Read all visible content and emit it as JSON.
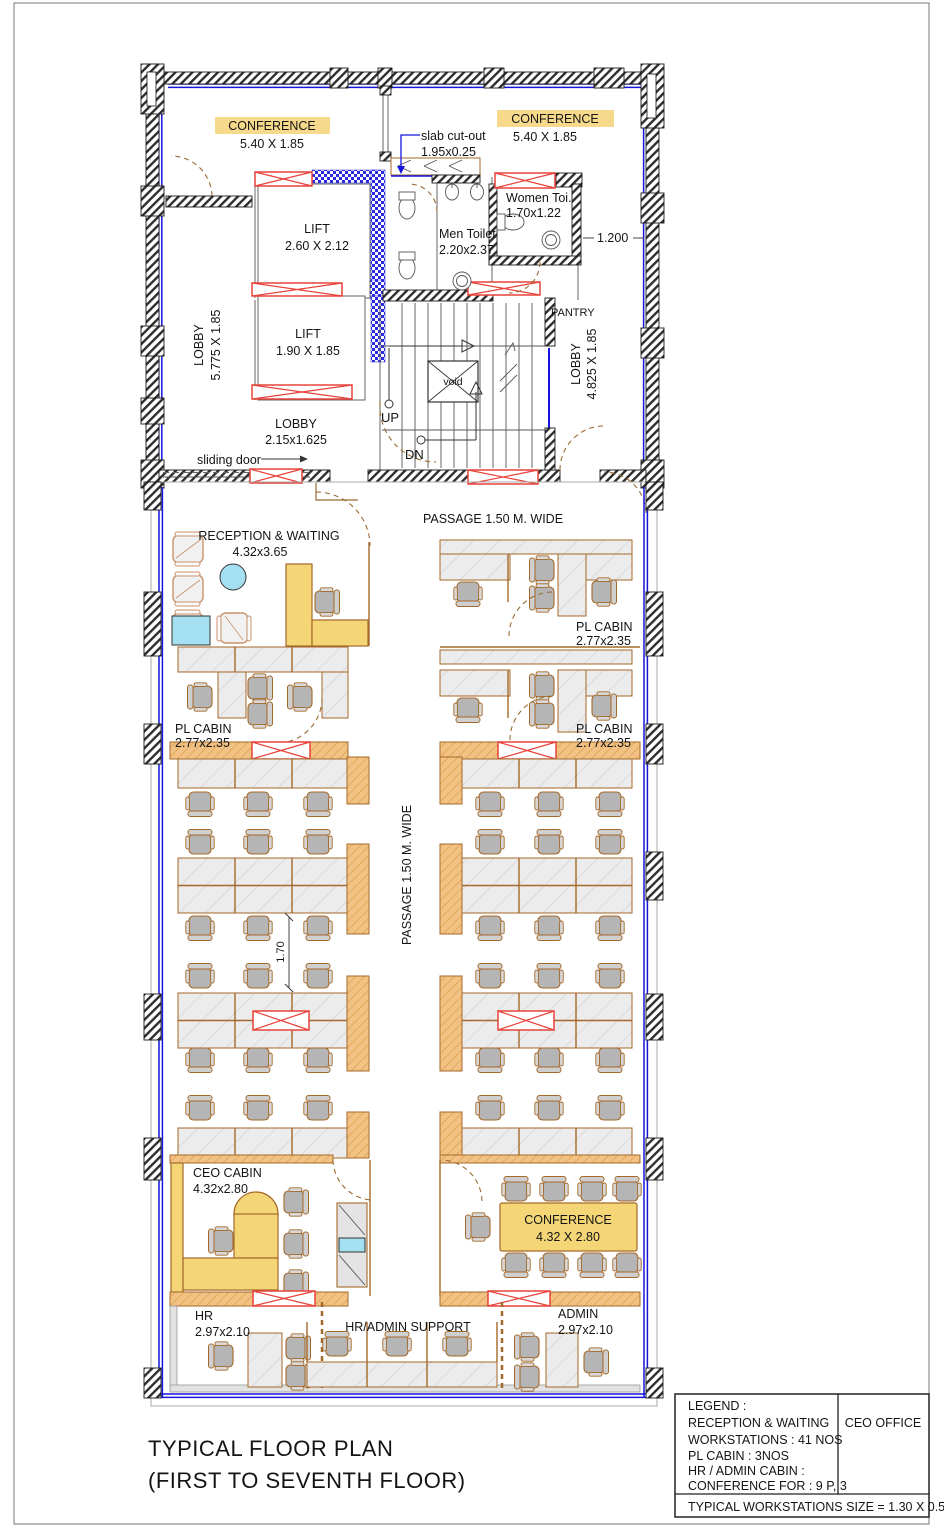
{
  "sheet": {
    "title_line1": "TYPICAL FLOOR PLAN",
    "title_line2": "(FIRST TO SEVENTH FLOOR)"
  },
  "legend": {
    "heading": "LEGEND :",
    "line1": "RECEPTION & WAITING",
    "line2": "WORKSTATIONS  : 41 NOS",
    "line3": "PL CABIN : 3NOS",
    "line4": "HR / ADMIN CABIN  :",
    "line5": "CONFERENCE FOR : 9 P, 3",
    "project": "CEO OFFICE",
    "footer": "TYPICAL WORKSTATIONS SIZE = 1.30 X 0.55"
  },
  "rooms": {
    "conference_top_left": {
      "name": "CONFERENCE",
      "dims": "5.40 X 1.85"
    },
    "conference_top_right": {
      "name": "CONFERENCE",
      "dims": "5.40 X 1.85"
    },
    "lift_upper": {
      "name": "LIFT",
      "dims": "2.60 X 2.12"
    },
    "lift_lower": {
      "name": "LIFT",
      "dims": "1.90 X 1.85"
    },
    "men_toilet": {
      "name": "Men Toilet",
      "dims": "2.20x2.37"
    },
    "women_toilet": {
      "name": "Women Toi.",
      "dims": "1.70x1.22"
    },
    "pantry": {
      "name": "PANTRY"
    },
    "lobby_left": {
      "name": "LOBBY",
      "dims": "5.775 X 1.85"
    },
    "lobby_right": {
      "name": "LOBBY",
      "dims": "4.825 X 1.85"
    },
    "lobby_center": {
      "name": "LOBBY",
      "dims": "2.15x1.625"
    },
    "reception": {
      "name": "RECEPTION & WAITING",
      "dims": "4.32x3.65"
    },
    "pl_cabin_right_upper": {
      "name": "PL CABIN",
      "dims": "2.77x2.35"
    },
    "pl_cabin_left": {
      "name": "PL CABIN",
      "dims": "2.77x2.35"
    },
    "pl_cabin_right_lower": {
      "name": "PL CABIN",
      "dims": "2.77x2.35"
    },
    "ceo_cabin": {
      "name": "CEO CABIN",
      "dims": "4.32x2.80"
    },
    "conference_bottom": {
      "name": "CONFERENCE",
      "dims": "4.32 X 2.80"
    },
    "hr": {
      "name": "HR",
      "dims": "2.97x2.10"
    },
    "hr_admin_support": {
      "name": "HR/ADMIN SUPPORT"
    },
    "admin": {
      "name": "ADMIN",
      "dims": "2.97x2.10"
    }
  },
  "annotations": {
    "slab_cutout_line1": "slab cut-out",
    "slab_cutout_line2": "1.95x0.25",
    "dim_1_200": "1.200",
    "dim_1_70": "1.70",
    "sliding_door": "sliding door",
    "up": "UP",
    "dn": "DN",
    "void": "void",
    "passage_top": "PASSAGE 1.50 M. WIDE",
    "passage_center": "PASSAGE 1.50 M. WIDE"
  },
  "colors": {
    "glazing_blue": "#1515dd",
    "opening_red": "#e8423a",
    "furniture_tan": "#a4692a",
    "highlight_yellow": "#f7d98c",
    "panel_orange": "#f2c285",
    "water_blue": "#a5dff2",
    "wall_black": "#1a1a1a"
  }
}
